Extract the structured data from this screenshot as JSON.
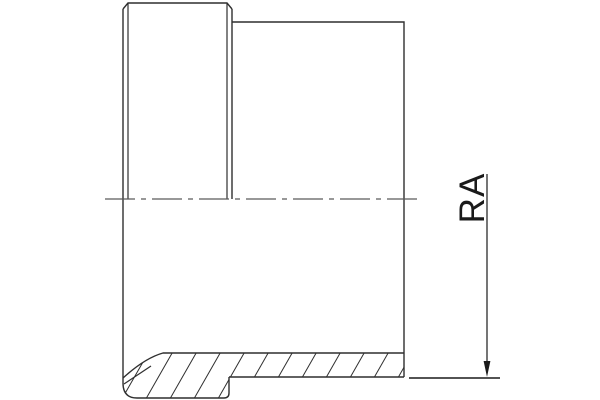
{
  "drawing": {
    "description_label": "pipe-fitting-half-section",
    "dimension": {
      "label": "RA"
    },
    "colors": {
      "background": "#ffffff",
      "outline": "#2f2f2f",
      "centerline": "#5a5a5a",
      "dimension": "#1a1a1a"
    }
  }
}
